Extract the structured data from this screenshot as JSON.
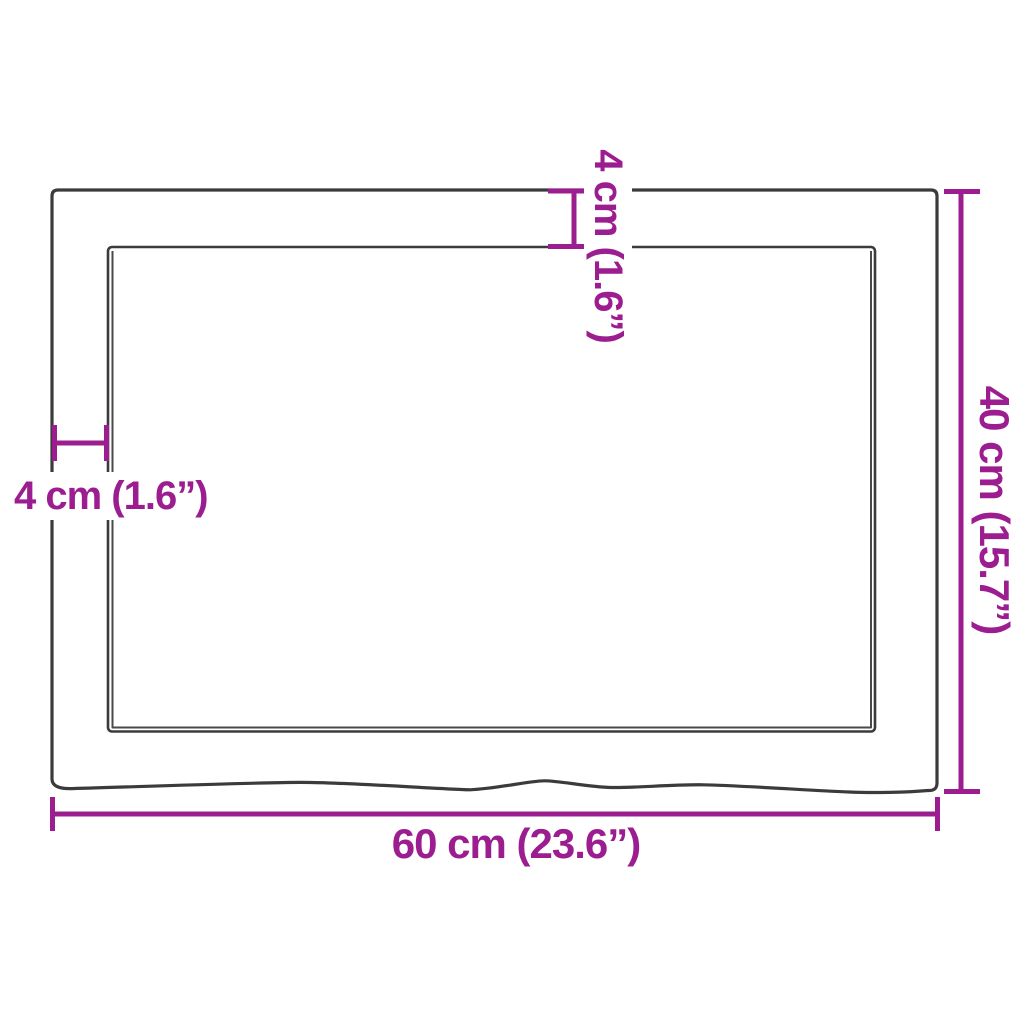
{
  "colors": {
    "dimension_accent": "#9c1d8f",
    "outline": "#3b3b3b",
    "background": "#ffffff"
  },
  "diagram": {
    "type": "product-dimension-diagram",
    "labels": {
      "top_thickness": "4 cm (1.6”)",
      "left_thickness": "4 cm (1.6”)",
      "height": "40 cm (15.7”)",
      "width": "60 cm (23.6”)"
    },
    "measurements": {
      "width_cm": "60",
      "width_inches": "23.6",
      "height_cm": "40",
      "height_inches": "15.7",
      "edge_cm": "4",
      "edge_inches": "1.6"
    }
  }
}
